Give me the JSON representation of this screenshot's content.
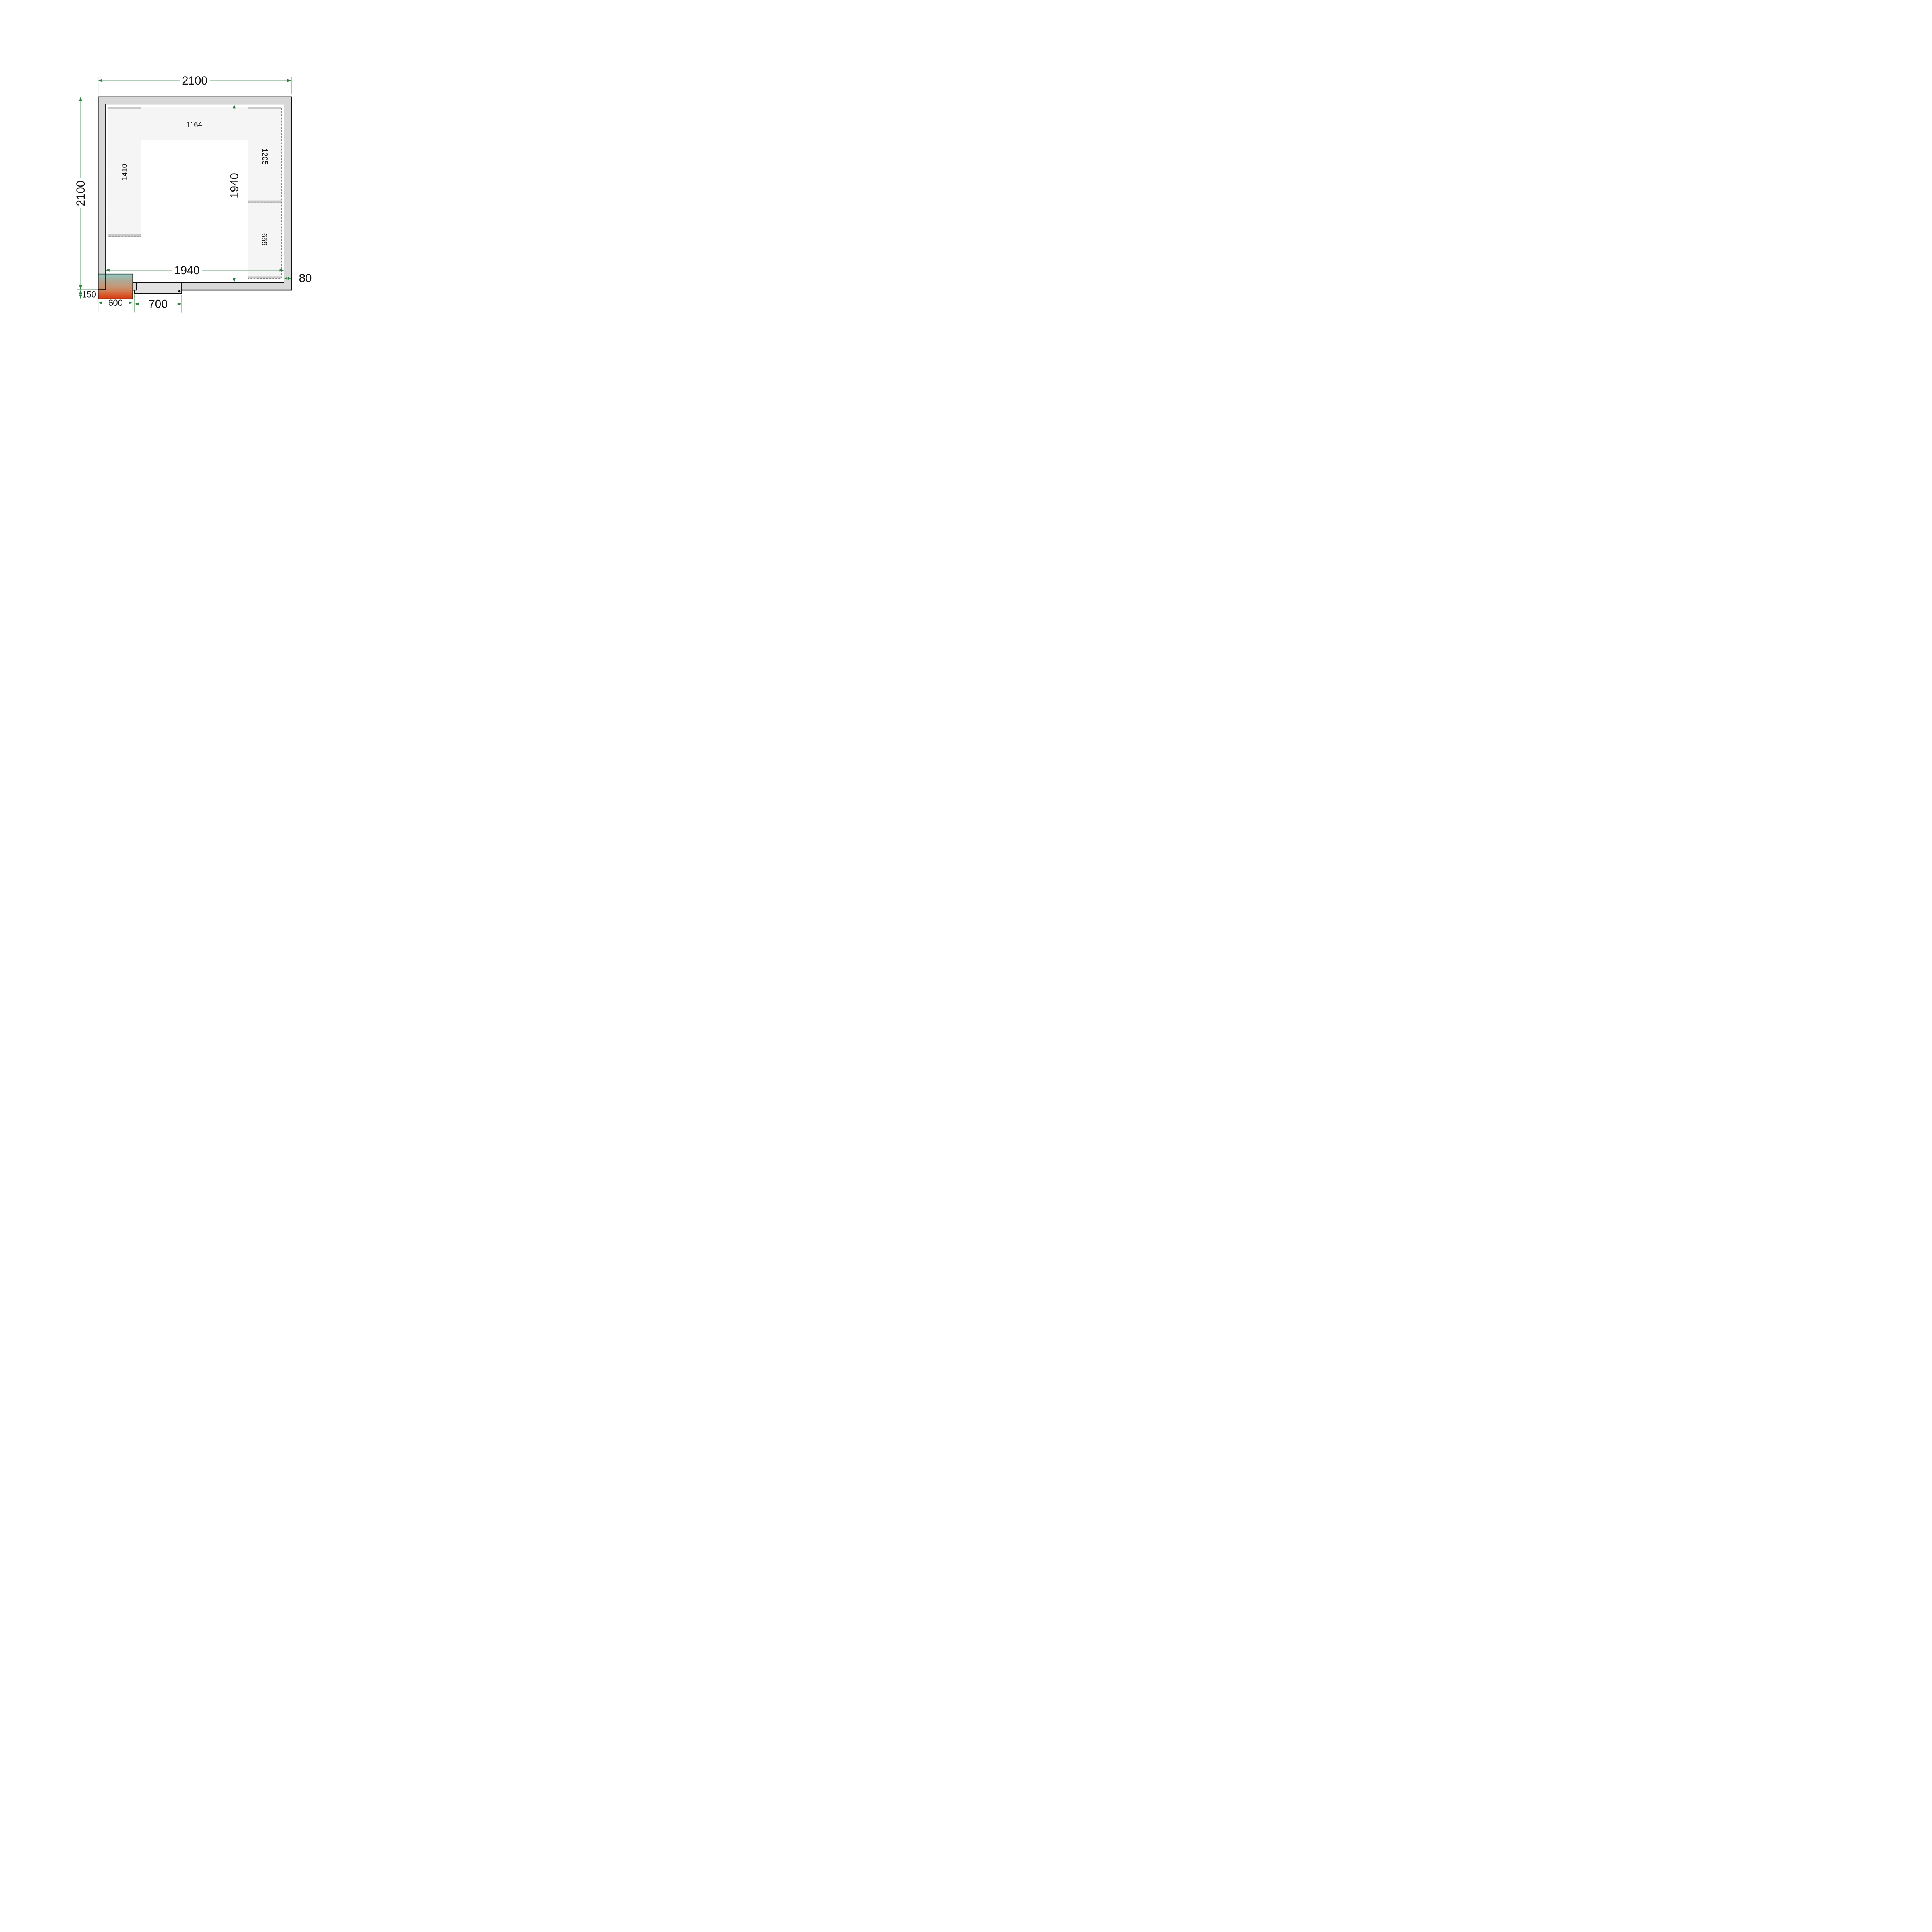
{
  "figure": {
    "room": {
      "outer_width_label": "2100",
      "outer_height_label": "2100",
      "inner_width_label": "1940",
      "inner_height_label": "1940",
      "wall_thickness_label": "80"
    },
    "door": {
      "width_label": "700"
    },
    "cooling_unit": {
      "width_label": "600",
      "protrusion_label": "150"
    },
    "shelves": {
      "top_label": "1164",
      "left_label": "1410",
      "right_upper_label": "1205",
      "right_lower_label": "659"
    },
    "colors": {
      "dimension_green": "#2f7e41",
      "extension_green": "#4c8e5c",
      "wall_fill": "#d8d8d8",
      "shelf_fill": "#f5f5f5",
      "shelf_strip": "#c9c9c9",
      "door_leaf_fill": "#e2e2e2",
      "cooler_gradient_top": "#8fc9c1",
      "cooler_gradient_bottom": "#dc3a11"
    }
  }
}
